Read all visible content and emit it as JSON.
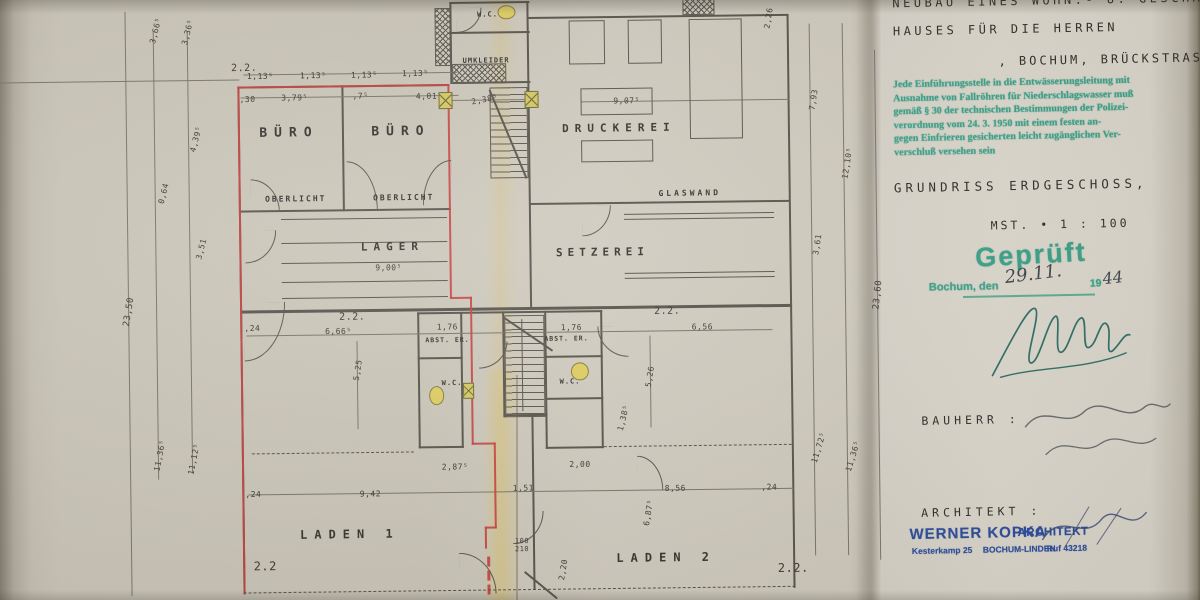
{
  "colors": {
    "paper": "#ccc7ba",
    "paper_right": "#dcd8cd",
    "pencil": "#57544c",
    "red_line": "#c8403e",
    "teal_stamp": "#3aa188",
    "blue_stamp": "#2d4d9e",
    "yellow_marker": "#d6c95f"
  },
  "title_block": {
    "line1": "NEUBAU EINES WOHN.- U. GESCHÄFTS-",
    "line2": "HAUSES FÜR DIE HERREN",
    "line3": ", BOCHUM, BRÜCKSTRASSE.",
    "stamp_green_lines": [
      "Jede Einführungsstelle in die Entwässerungsleitung mit",
      "Ausnahme von Fallröhren für Niederschlagswasser muß",
      "gemäß § 30 der technischen Bestimmungen der Polizei-",
      "verordnung vom 24. 3. 1950 mit einem festen an-",
      "gegen Einfrieren gesicherten leicht zugänglichen Ver-",
      "verschluß versehen sein"
    ],
    "drawing_title": "GRUNDRISS ERDGESCHOSS,",
    "scale_label": "MST. •  1 : 100",
    "approved_stamp": "Geprüft",
    "approved_place": "Bochum, den",
    "approved_date_hand": "29.11.",
    "approved_year_print": "19",
    "approved_year_hand": "44",
    "bauherr_label": "BAUHERR :",
    "architekt_label": "ARCHITEKT :",
    "stamp_name": "WERNER KOPKA",
    "stamp_title": "ARCHITEKT",
    "stamp_address": "Kesterkamp 25",
    "stamp_city": "BOCHUM-LINDEN",
    "stamp_phone": "Ruf 43218"
  },
  "plan": {
    "rooms": [
      {
        "label": "BÜRO",
        "x": 291,
        "y": 131,
        "fs": 13,
        "ls": 7
      },
      {
        "label": "BÜRO",
        "x": 403,
        "y": 131,
        "fs": 13,
        "ls": 7
      },
      {
        "label": "OBERLICHT",
        "x": 297,
        "y": 197,
        "fs": 8,
        "ls": 2
      },
      {
        "label": "OBERLICHT",
        "x": 405,
        "y": 197,
        "fs": 8,
        "ls": 2
      },
      {
        "label": "LAGER",
        "x": 393,
        "y": 246,
        "fs": 11,
        "ls": 6
      },
      {
        "label": "W.C.",
        "x": 491,
        "y": 15,
        "fs": 7,
        "ls": 1
      },
      {
        "label": "UMKLEIDER",
        "x": 489,
        "y": 61,
        "fs": 7,
        "ls": 1
      },
      {
        "label": "DRUCKEREI",
        "x": 621,
        "y": 130,
        "fs": 11,
        "ls": 6
      },
      {
        "label": "GLASWAND",
        "x": 691,
        "y": 196,
        "fs": 8,
        "ls": 3
      },
      {
        "label": "SETZEREI",
        "x": 603,
        "y": 254,
        "fs": 11,
        "ls": 5
      },
      {
        "label": "ABST. ER.",
        "x": 447,
        "y": 340,
        "fs": 6.5,
        "ls": 1
      },
      {
        "label": "ABST. ER.",
        "x": 566,
        "y": 340,
        "fs": 6.5,
        "ls": 1
      },
      {
        "label": "W.C.",
        "x": 451,
        "y": 383,
        "fs": 7,
        "ls": 1
      },
      {
        "label": "W.C.",
        "x": 569,
        "y": 383,
        "fs": 7,
        "ls": 1
      },
      {
        "label": "LADEN 1",
        "x": 347,
        "y": 533,
        "fs": 12,
        "ls": 7
      },
      {
        "label": "LADEN 2",
        "x": 663,
        "y": 560,
        "fs": 12,
        "ls": 7
      }
    ],
    "dims": [
      {
        "t": "2.2.",
        "x": 247,
        "y": 66,
        "fs": 10
      },
      {
        "t": "1,13⁵",
        "x": 263,
        "y": 74
      },
      {
        "t": "1,13⁵",
        "x": 316,
        "y": 74
      },
      {
        "t": "1,13⁵",
        "x": 367,
        "y": 74
      },
      {
        "t": "1,13⁵",
        "x": 418,
        "y": 73
      },
      {
        "t": ",30",
        "x": 250,
        "y": 97
      },
      {
        "t": "3,79⁵",
        "x": 297,
        "y": 96
      },
      {
        "t": ",7⁵",
        "x": 363,
        "y": 95
      },
      {
        "t": "4,01",
        "x": 429,
        "y": 96
      },
      {
        "t": "2,38⁵",
        "x": 487,
        "y": 100,
        "r": -10
      },
      {
        "t": "9,07⁵",
        "x": 629,
        "y": 103
      },
      {
        "t": "3,66⁵",
        "x": 159,
        "y": 27,
        "r": -75
      },
      {
        "t": "3,36⁵",
        "x": 191,
        "y": 29,
        "r": -75
      },
      {
        "t": "4,39⁵",
        "x": 198,
        "y": 136,
        "r": -75
      },
      {
        "t": "0,64",
        "x": 165,
        "y": 190,
        "r": -75
      },
      {
        "t": "3,51",
        "x": 202,
        "y": 246,
        "r": -75
      },
      {
        "t": "23,50",
        "x": 129,
        "y": 308,
        "r": -80,
        "fs": 9
      },
      {
        "t": "11,36⁵",
        "x": 158,
        "y": 452,
        "r": -78
      },
      {
        "t": "11,12⁵",
        "x": 192,
        "y": 456,
        "r": -78
      },
      {
        "t": "2,26",
        "x": 772,
        "y": 22,
        "r": -80
      },
      {
        "t": "7,93",
        "x": 816,
        "y": 104,
        "r": -80
      },
      {
        "t": "12,10⁵",
        "x": 849,
        "y": 168,
        "r": -80
      },
      {
        "t": "3,61",
        "x": 818,
        "y": 249,
        "r": -80
      },
      {
        "t": "23,60",
        "x": 878,
        "y": 300,
        "r": -83,
        "fs": 9
      },
      {
        "t": "11,72⁵",
        "x": 817,
        "y": 452,
        "r": -72
      },
      {
        "t": "11,36⁵",
        "x": 851,
        "y": 461,
        "r": -72
      },
      {
        "t": "2.2.",
        "x": 352,
        "y": 316,
        "fs": 10
      },
      {
        "t": "2.2.",
        "x": 667,
        "y": 314,
        "fs": 10
      },
      {
        "t": "6,66⁵",
        "x": 338,
        "y": 330
      },
      {
        "t": "1,76",
        "x": 447,
        "y": 327
      },
      {
        "t": "1,76",
        "x": 571,
        "y": 329
      },
      {
        "t": "6,56",
        "x": 702,
        "y": 330
      },
      {
        "t": ",24",
        "x": 252,
        "y": 326
      },
      {
        "t": "9,00⁵",
        "x": 389,
        "y": 267
      },
      {
        "t": "5,25",
        "x": 357,
        "y": 369,
        "r": -80
      },
      {
        "t": "5,26",
        "x": 649,
        "y": 379,
        "r": -80
      },
      {
        "t": "1,38⁵",
        "x": 622,
        "y": 420,
        "r": -75
      },
      {
        "t": "2,87⁵",
        "x": 453,
        "y": 467
      },
      {
        "t": "2,00",
        "x": 578,
        "y": 466
      },
      {
        "t": "9,42",
        "x": 368,
        "y": 493
      },
      {
        "t": "1,51",
        "x": 521,
        "y": 489
      },
      {
        "t": "8,56",
        "x": 673,
        "y": 491
      },
      {
        "t": ",24",
        "x": 251,
        "y": 492
      },
      {
        "t": ",24",
        "x": 767,
        "y": 491
      },
      {
        "t": "100",
        "x": 519,
        "y": 542,
        "fs": 7
      },
      {
        "t": "210",
        "x": 519,
        "y": 550,
        "fs": 7
      },
      {
        "t": "2,20",
        "x": 560,
        "y": 571,
        "r": -80
      },
      {
        "t": "6,87⁵",
        "x": 646,
        "y": 515,
        "r": -80
      },
      {
        "t": "2.2",
        "x": 262,
        "y": 564,
        "fs": 12
      },
      {
        "t": "2.2.",
        "x": 790,
        "y": 572,
        "fs": 12
      }
    ]
  }
}
